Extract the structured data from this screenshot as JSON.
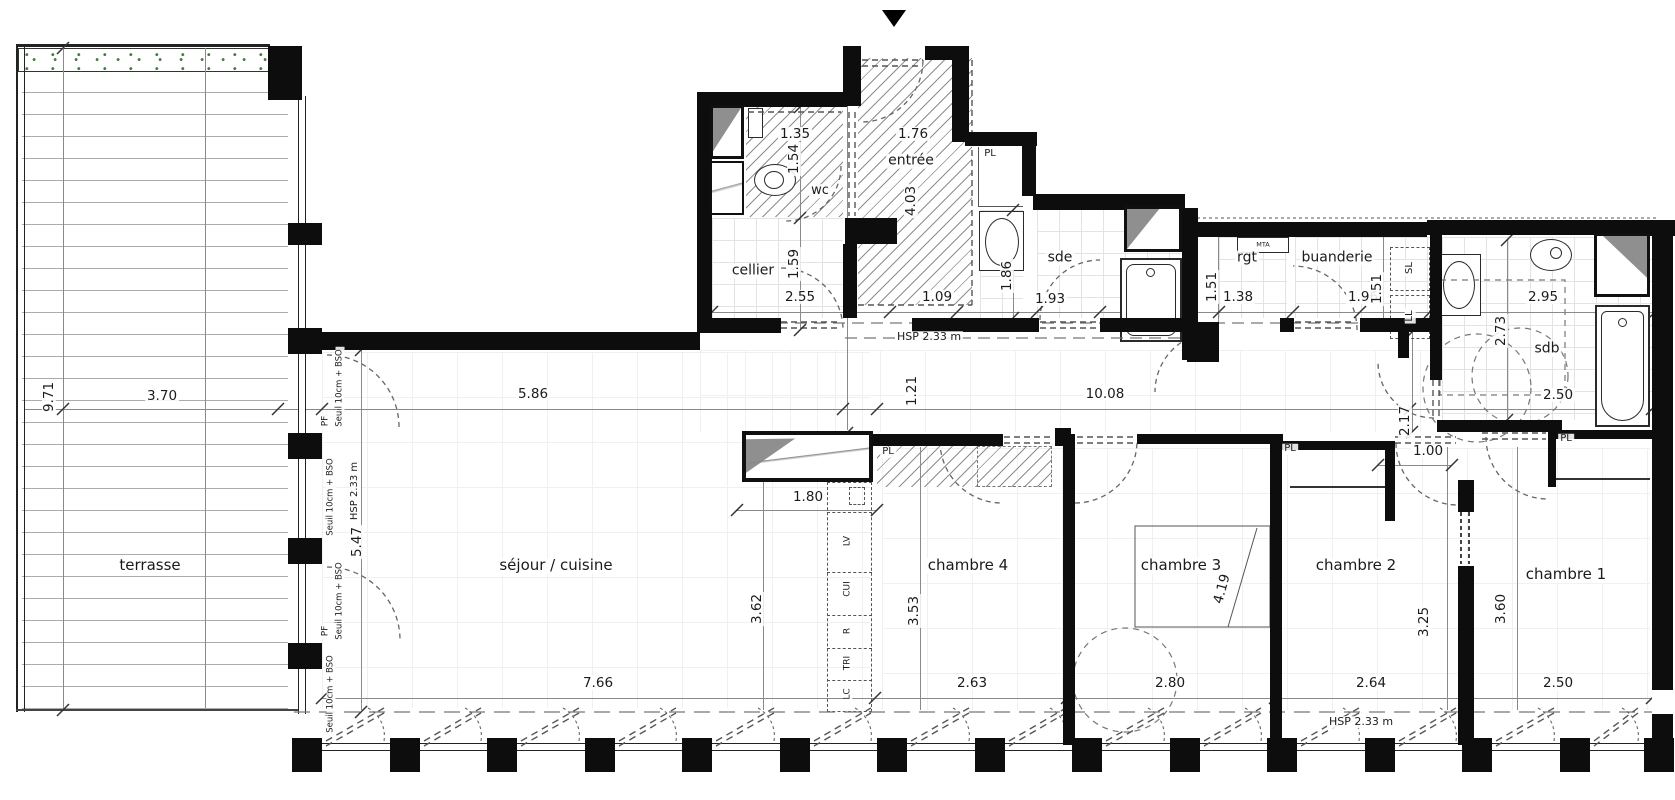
{
  "document": {
    "type": "architectural floor plan (apartment)",
    "colors": {
      "wall": "#0d0d0d",
      "hatch_lines": "#8d8d8d",
      "tile_grid": "#e3e3e3",
      "dashed_lines": "#666666",
      "planting_green": "#44793f",
      "window_gray": "#8f8f8f"
    }
  },
  "labels": {
    "rooms": [
      {
        "name": "terrasse",
        "text": "terrasse",
        "x": 150,
        "y": 566
      },
      {
        "name": "sejour-cuisine",
        "text": "séjour / cuisine",
        "x": 556,
        "y": 566
      },
      {
        "name": "chambre-4",
        "text": "chambre 4",
        "x": 968,
        "y": 566
      },
      {
        "name": "chambre-3",
        "text": "chambre 3",
        "x": 1181,
        "y": 566
      },
      {
        "name": "chambre-2",
        "text": "chambre 2",
        "x": 1356,
        "y": 566
      },
      {
        "name": "chambre-1",
        "text": "chambre 1",
        "x": 1566,
        "y": 575
      },
      {
        "name": "wc",
        "text": "wc",
        "x": 820,
        "y": 191,
        "fs": 13
      },
      {
        "name": "entree",
        "text": "entrée",
        "x": 911,
        "y": 161,
        "fs": 14
      },
      {
        "name": "cellier",
        "text": "cellier",
        "x": 753,
        "y": 271,
        "fs": 14
      },
      {
        "name": "sde",
        "text": "sde",
        "x": 1060,
        "y": 258,
        "fs": 14
      },
      {
        "name": "rgt",
        "text": "rgt",
        "x": 1247,
        "y": 258,
        "fs": 14
      },
      {
        "name": "buanderie",
        "text": "buanderie",
        "x": 1337,
        "y": 258,
        "fs": 14
      },
      {
        "name": "sdb",
        "text": "sdb",
        "x": 1547,
        "y": 349,
        "fs": 14
      }
    ],
    "closets": [
      {
        "name": "pl-entree",
        "text": "PL",
        "x": 990,
        "y": 154
      },
      {
        "name": "pl-couloir",
        "text": "PL",
        "x": 888,
        "y": 452
      },
      {
        "name": "pl-chambre2",
        "text": "PL",
        "x": 1290,
        "y": 449
      },
      {
        "name": "pl-chambre1",
        "text": "PL",
        "x": 1566,
        "y": 439
      },
      {
        "name": "mta",
        "text": "MTA",
        "x": 1263,
        "y": 245,
        "fs": 6.5
      }
    ],
    "appliances": [
      {
        "name": "seche-linge",
        "text": "SL",
        "x": 1410,
        "y": 268,
        "r": -90
      },
      {
        "name": "lave-linge",
        "text": "LL",
        "x": 1410,
        "y": 316,
        "r": -90
      }
    ],
    "kitchen": [
      {
        "name": "lave-vaisselle",
        "text": "LV",
        "x": 848,
        "y": 541,
        "r": -90
      },
      {
        "name": "cuisson",
        "text": "CUI",
        "x": 848,
        "y": 589,
        "r": -90
      },
      {
        "name": "refrigerateur",
        "text": "R",
        "x": 848,
        "y": 631,
        "r": -90
      },
      {
        "name": "tri",
        "text": "TRI",
        "x": 848,
        "y": 663,
        "r": -90
      },
      {
        "name": "lave-coude",
        "text": "LC",
        "x": 848,
        "y": 694,
        "r": -90
      }
    ],
    "dims_h": [
      {
        "text": "1.35",
        "x": 795,
        "y": 134
      },
      {
        "text": "1.76",
        "x": 913,
        "y": 134
      },
      {
        "text": "2.55",
        "x": 800,
        "y": 297
      },
      {
        "text": "1.09",
        "x": 937,
        "y": 297
      },
      {
        "text": "1.93",
        "x": 1050,
        "y": 299
      },
      {
        "text": "1.38",
        "x": 1238,
        "y": 297
      },
      {
        "text": "1.96",
        "x": 1363,
        "y": 297
      },
      {
        "text": "2.95",
        "x": 1543,
        "y": 297
      },
      {
        "text": "2.50",
        "x": 1558,
        "y": 395
      },
      {
        "text": "3.70",
        "x": 162,
        "y": 396
      },
      {
        "text": "5.86",
        "x": 533,
        "y": 394
      },
      {
        "text": "10.08",
        "x": 1105,
        "y": 394
      },
      {
        "text": "1.00",
        "x": 1428,
        "y": 451
      },
      {
        "text": "1.80",
        "x": 808,
        "y": 497
      },
      {
        "text": "7.66",
        "x": 598,
        "y": 683
      },
      {
        "text": "2.63",
        "x": 972,
        "y": 683
      },
      {
        "text": "2.80",
        "x": 1170,
        "y": 683
      },
      {
        "text": "2.64",
        "x": 1371,
        "y": 683
      },
      {
        "text": "2.50",
        "x": 1558,
        "y": 683
      }
    ],
    "dims_v": [
      {
        "text": "1.54",
        "x": 794,
        "y": 159,
        "r": -90
      },
      {
        "text": "4.03",
        "x": 911,
        "y": 201,
        "r": -90
      },
      {
        "text": "1.59",
        "x": 794,
        "y": 264,
        "r": -90
      },
      {
        "text": "1.86",
        "x": 1007,
        "y": 276,
        "r": -90
      },
      {
        "text": "1.51",
        "x": 1212,
        "y": 287,
        "r": -90
      },
      {
        "text": "1.51",
        "x": 1377,
        "y": 289,
        "r": -90
      },
      {
        "text": "2.73",
        "x": 1501,
        "y": 331,
        "r": -90
      },
      {
        "text": "9.71",
        "x": 49,
        "y": 397,
        "r": -90
      },
      {
        "text": "1.21",
        "x": 912,
        "y": 391,
        "r": -90
      },
      {
        "text": "5.47",
        "x": 357,
        "y": 542,
        "r": -90
      },
      {
        "text": "3.62",
        "x": 757,
        "y": 609,
        "r": -90
      },
      {
        "text": "3.53",
        "x": 914,
        "y": 611,
        "r": -90
      },
      {
        "text": "4.19",
        "x": 1222,
        "y": 589,
        "r": -75
      },
      {
        "text": "2.17",
        "x": 1405,
        "y": 421,
        "r": -90
      },
      {
        "text": "3.25",
        "x": 1424,
        "y": 622,
        "r": -90
      },
      {
        "text": "3.60",
        "x": 1501,
        "y": 609,
        "r": -90
      }
    ],
    "annotations": [
      {
        "name": "hsp-corridor",
        "text": "HSP 2.33 m",
        "x": 929,
        "y": 337
      },
      {
        "name": "hsp-bottom",
        "text": "HSP 2.33 m",
        "x": 1361,
        "y": 722
      },
      {
        "name": "hsp-west",
        "text": "HSP 2.33 m",
        "x": 355,
        "y": 491,
        "r": -90,
        "fs": 10
      },
      {
        "name": "pf-1",
        "text": "PF",
        "x": 326,
        "y": 421,
        "r": -90,
        "fs": 9
      },
      {
        "name": "pf-2",
        "text": "PF",
        "x": 326,
        "y": 631,
        "r": -90,
        "fs": 9
      },
      {
        "name": "seuil-1",
        "text": "Seuil 10cm + BSO",
        "x": 340,
        "y": 388,
        "r": -90,
        "fs": 8.5
      },
      {
        "name": "seuil-2",
        "text": "Seuil 10cm + BSO",
        "x": 331,
        "y": 497,
        "r": -90,
        "fs": 8.5
      },
      {
        "name": "seuil-3",
        "text": "Seuil 10cm + BSO",
        "x": 340,
        "y": 601,
        "r": -90,
        "fs": 8.5
      },
      {
        "name": "seuil-4",
        "text": "Seuil 10cm + BSO",
        "x": 331,
        "y": 694,
        "r": -90,
        "fs": 8.5
      }
    ]
  }
}
